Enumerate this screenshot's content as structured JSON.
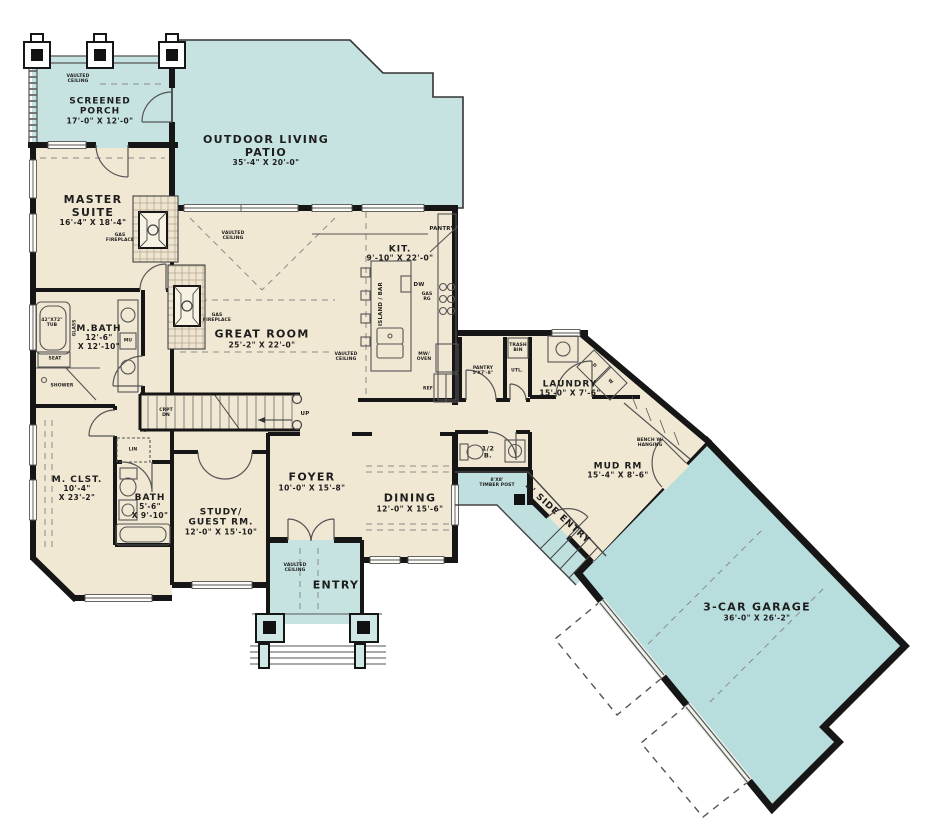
{
  "plan": {
    "colors": {
      "floor": "#f1e8d3",
      "outdoor": "#c6e3e1",
      "garage_fill": "#b7dedd",
      "wall": "#161616",
      "line": "#555555",
      "text": "#1d1d1d"
    }
  },
  "rooms": {
    "screened_porch": {
      "line1": "SCREENED",
      "line2": "PORCH",
      "dims": "17'-0\" X 12'-0\""
    },
    "patio": {
      "line1": "OUTDOOR LIVING",
      "line2": "PATIO",
      "dims": "35'-4\" X 20'-0\""
    },
    "master_suite": {
      "line1": "MASTER",
      "line2": "SUITE",
      "dims": "16'-4\" X 18'-4\""
    },
    "great_room": {
      "line1": "GREAT ROOM",
      "dims": "25'-2\" X 22'-0\""
    },
    "kitchen": {
      "line1": "KIT.",
      "dims": "9'-10\" X 22'-0\""
    },
    "master_bath": {
      "line1": "M.BATH",
      "dims1": "12'-6\"",
      "dims2": "X 12'-10\""
    },
    "master_closet": {
      "line1": "M. CLST.",
      "dims1": "10'-4\"",
      "dims2": "X 23'-2\""
    },
    "bath": {
      "line1": "BATH",
      "dims1": "5'-6\"",
      "dims2": "X 9'-10\""
    },
    "study": {
      "line1": "STUDY/",
      "line2": "GUEST RM.",
      "dims": "12'-0\" X 15'-10\""
    },
    "foyer": {
      "line1": "FOYER",
      "dims": "10'-0\" X 15'-8\""
    },
    "dining": {
      "line1": "DINING",
      "dims": "12'-0\" X 15'-6\""
    },
    "entry": {
      "line1": "ENTRY"
    },
    "half_bath": {
      "line1": "1/2",
      "line2": "B."
    },
    "laundry": {
      "line1": "LAUNDRY",
      "dims": "15'-0\" X 7'-6\""
    },
    "mud_room": {
      "line1": "MUD RM",
      "dims": "15'-4\" X 8'-6\""
    },
    "side_entry": {
      "line1": "4' SIDE ENTRY"
    },
    "garage": {
      "line1": "3-CAR GARAGE",
      "dims": "36'-0\" X 26'-2\""
    },
    "pantry_closet": {
      "line1": "PANTRY",
      "dims": "5'X7'-8\""
    },
    "utility": {
      "line1": "UTL."
    }
  },
  "annotations": {
    "vaulted1": "VAULTED",
    "vaulted2": "CEILING",
    "gas1": "GAS",
    "gas2": "FIREPLACE",
    "island_bar": "ISLAND / BAR",
    "dw": "DW",
    "ref": "REF",
    "mw1": "MW/",
    "mw2": "OVEN",
    "gas_rg1": "GAS",
    "gas_rg2": "RG",
    "pantry_corner": "PANTRY",
    "tub1": "42\"X72\"",
    "tub2": "TUB",
    "glass": "GLASS",
    "seat": "SEAT",
    "shower": "SHOWER",
    "mu": "MU",
    "lin": "LIN",
    "bench1": "BENCH W/",
    "bench2": "HANGING",
    "timber1": "8'X8'",
    "timber2": "TIMBER POST",
    "trash1": "TRASH",
    "trash2": "BIN",
    "washer": "W",
    "dryer": "D",
    "up": "UP",
    "dn1": "CRPT",
    "dn2": "DN"
  }
}
